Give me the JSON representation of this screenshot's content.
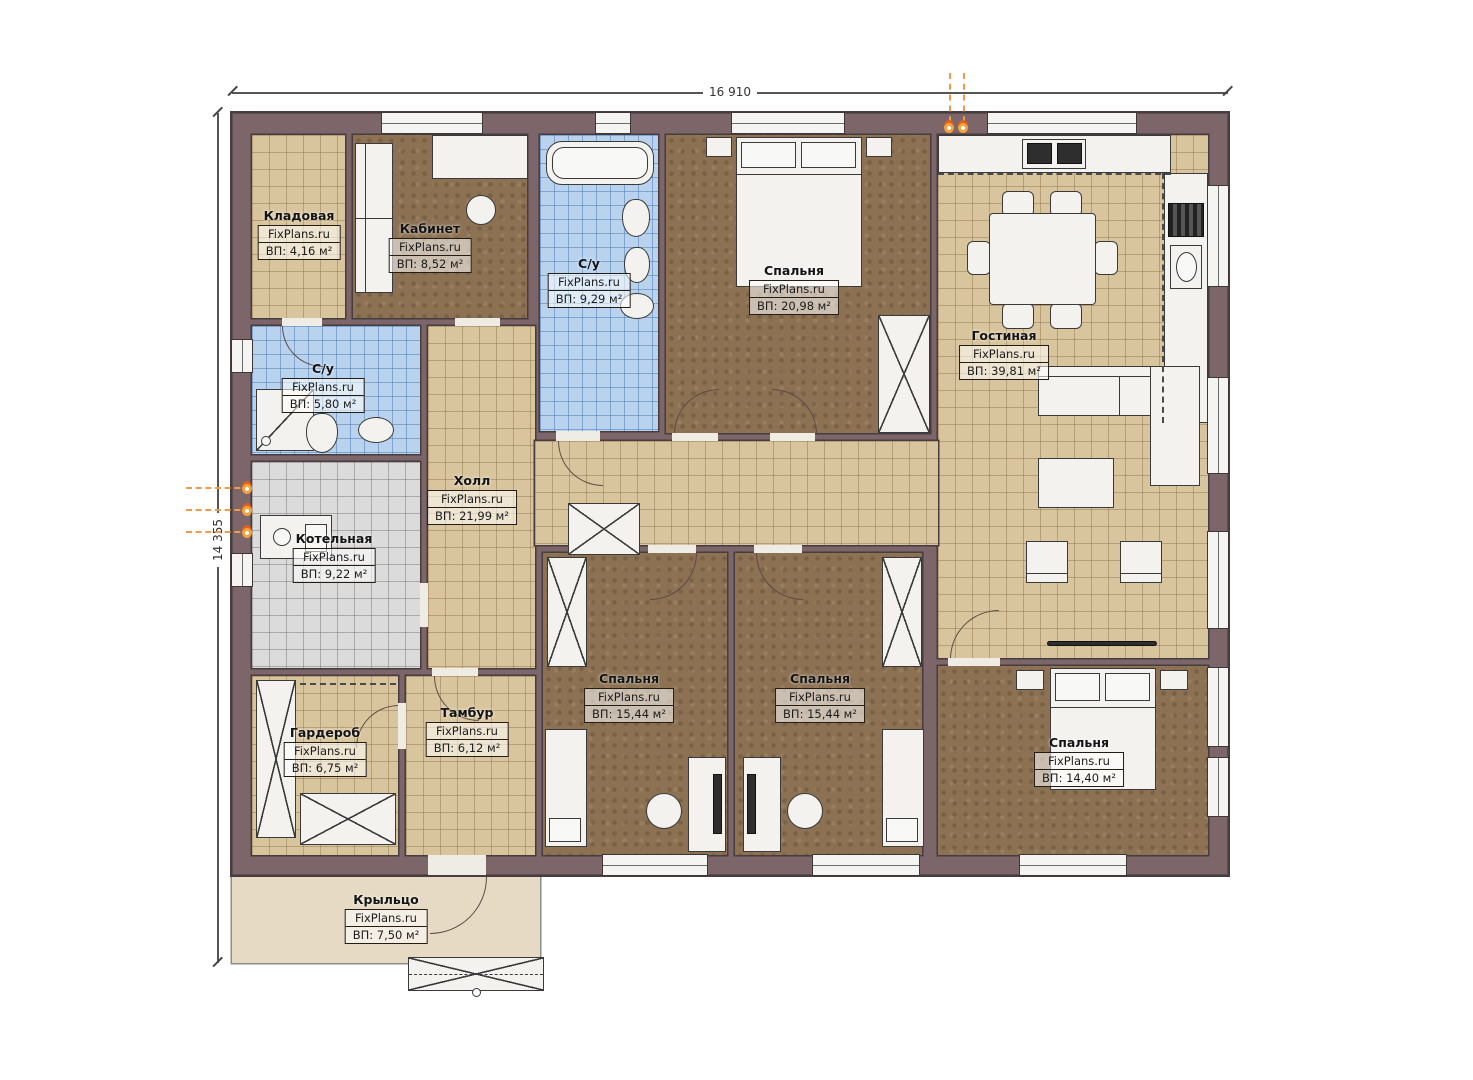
{
  "plan": {
    "watermark": "FixPlans.ru",
    "dimensions": {
      "width_label": "16 910",
      "height_label": "14 355"
    },
    "rooms": [
      {
        "id": "kladovaya",
        "name": "Кладовая",
        "area": "ВП: 4,16 м²"
      },
      {
        "id": "kabinet",
        "name": "Кабинет",
        "area": "ВП: 8,52 м²"
      },
      {
        "id": "su_top",
        "name": "С/у",
        "area": "ВП: 9,29 м²"
      },
      {
        "id": "bedroom_top",
        "name": "Спальня",
        "area": "ВП: 20,98 м²"
      },
      {
        "id": "gostinaya",
        "name": "Гостиная",
        "area": "ВП: 39,81 м²"
      },
      {
        "id": "su_left",
        "name": "С/у",
        "area": "ВП: 5,80 м²"
      },
      {
        "id": "holl",
        "name": "Холл",
        "area": "ВП: 21,99 м²"
      },
      {
        "id": "kotelnaya",
        "name": "Котельная",
        "area": "ВП: 9,22 м²"
      },
      {
        "id": "garderob",
        "name": "Гардероб",
        "area": "ВП: 6,75 м²"
      },
      {
        "id": "tambur",
        "name": "Тамбур",
        "area": "ВП: 6,12 м²"
      },
      {
        "id": "bedroom_b1",
        "name": "Спальня",
        "area": "ВП: 15,44 м²"
      },
      {
        "id": "bedroom_b2",
        "name": "Спальня",
        "area": "ВП: 15,44 м²"
      },
      {
        "id": "bedroom_br",
        "name": "Спальня",
        "area": "ВП: 14,40 м²"
      },
      {
        "id": "kryltso",
        "name": "Крыльцо",
        "area": "ВП: 7,50 м²"
      }
    ],
    "colors": {
      "wall": "#7c666a",
      "floor_tan": "#d9c59d",
      "floor_brown": "#8c7153",
      "floor_blue": "#b9d3ee",
      "floor_gray": "#dbdbdb",
      "porch": "#e6dac5",
      "gas_marker": "#f09a4b"
    }
  }
}
